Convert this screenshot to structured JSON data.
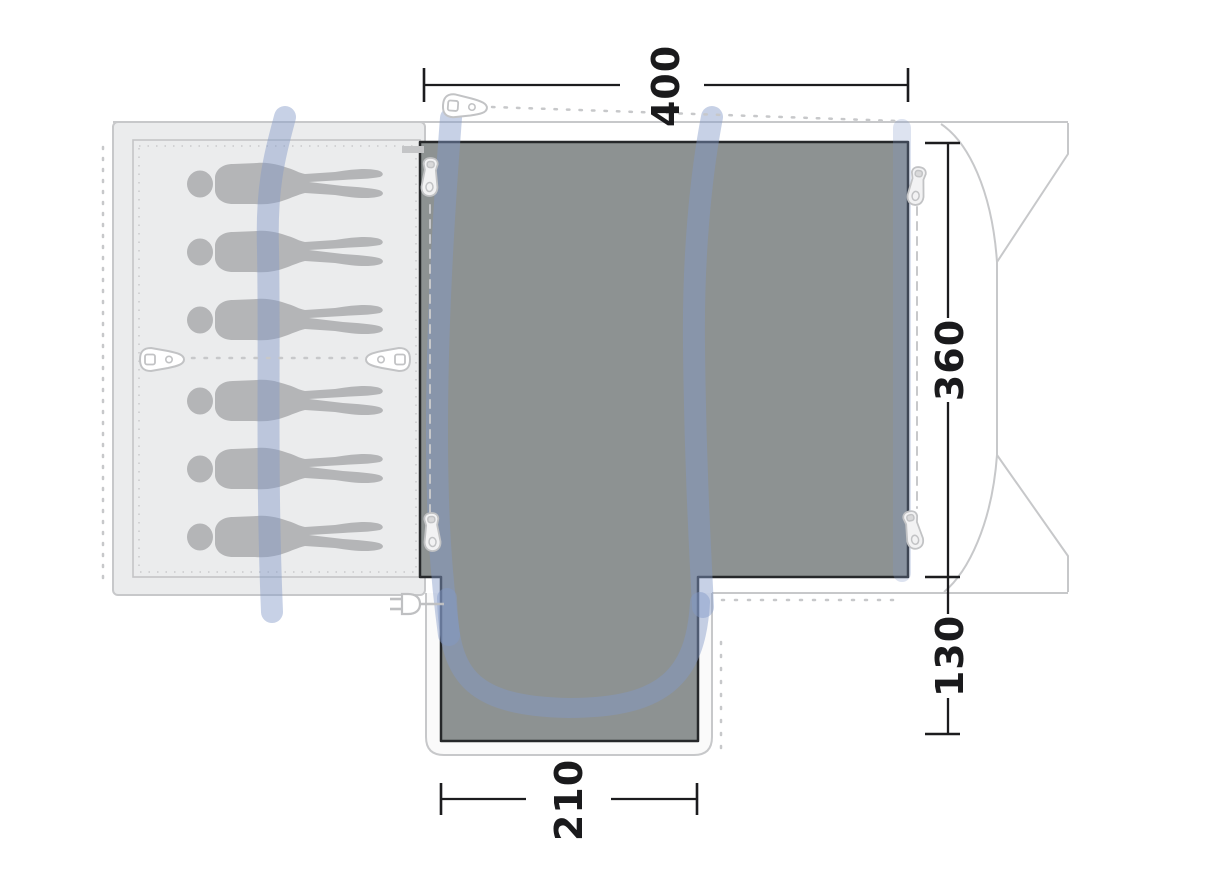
{
  "diagram": {
    "type": "tent-floorplan-top-view",
    "dimensions": {
      "top_width": "400",
      "side_depth": "360",
      "porch_depth": "130",
      "porch_width": "210"
    },
    "figures": {
      "count": 6,
      "description": "sleeping-person-silhouettes"
    },
    "icons": [
      "tent-peg-icon",
      "zipper-pull-icon",
      "power-plug-icon"
    ],
    "colors": {
      "groundsheet": "#8d9292",
      "groundsheet_border": "#26282a",
      "bedroom_fill": "#ebeced",
      "pole_band": "rgba(130,153,200,0.45)",
      "outline": "#c7c8ca",
      "figure": "#b4b5b7",
      "dimension": "#1a1a1c"
    }
  }
}
